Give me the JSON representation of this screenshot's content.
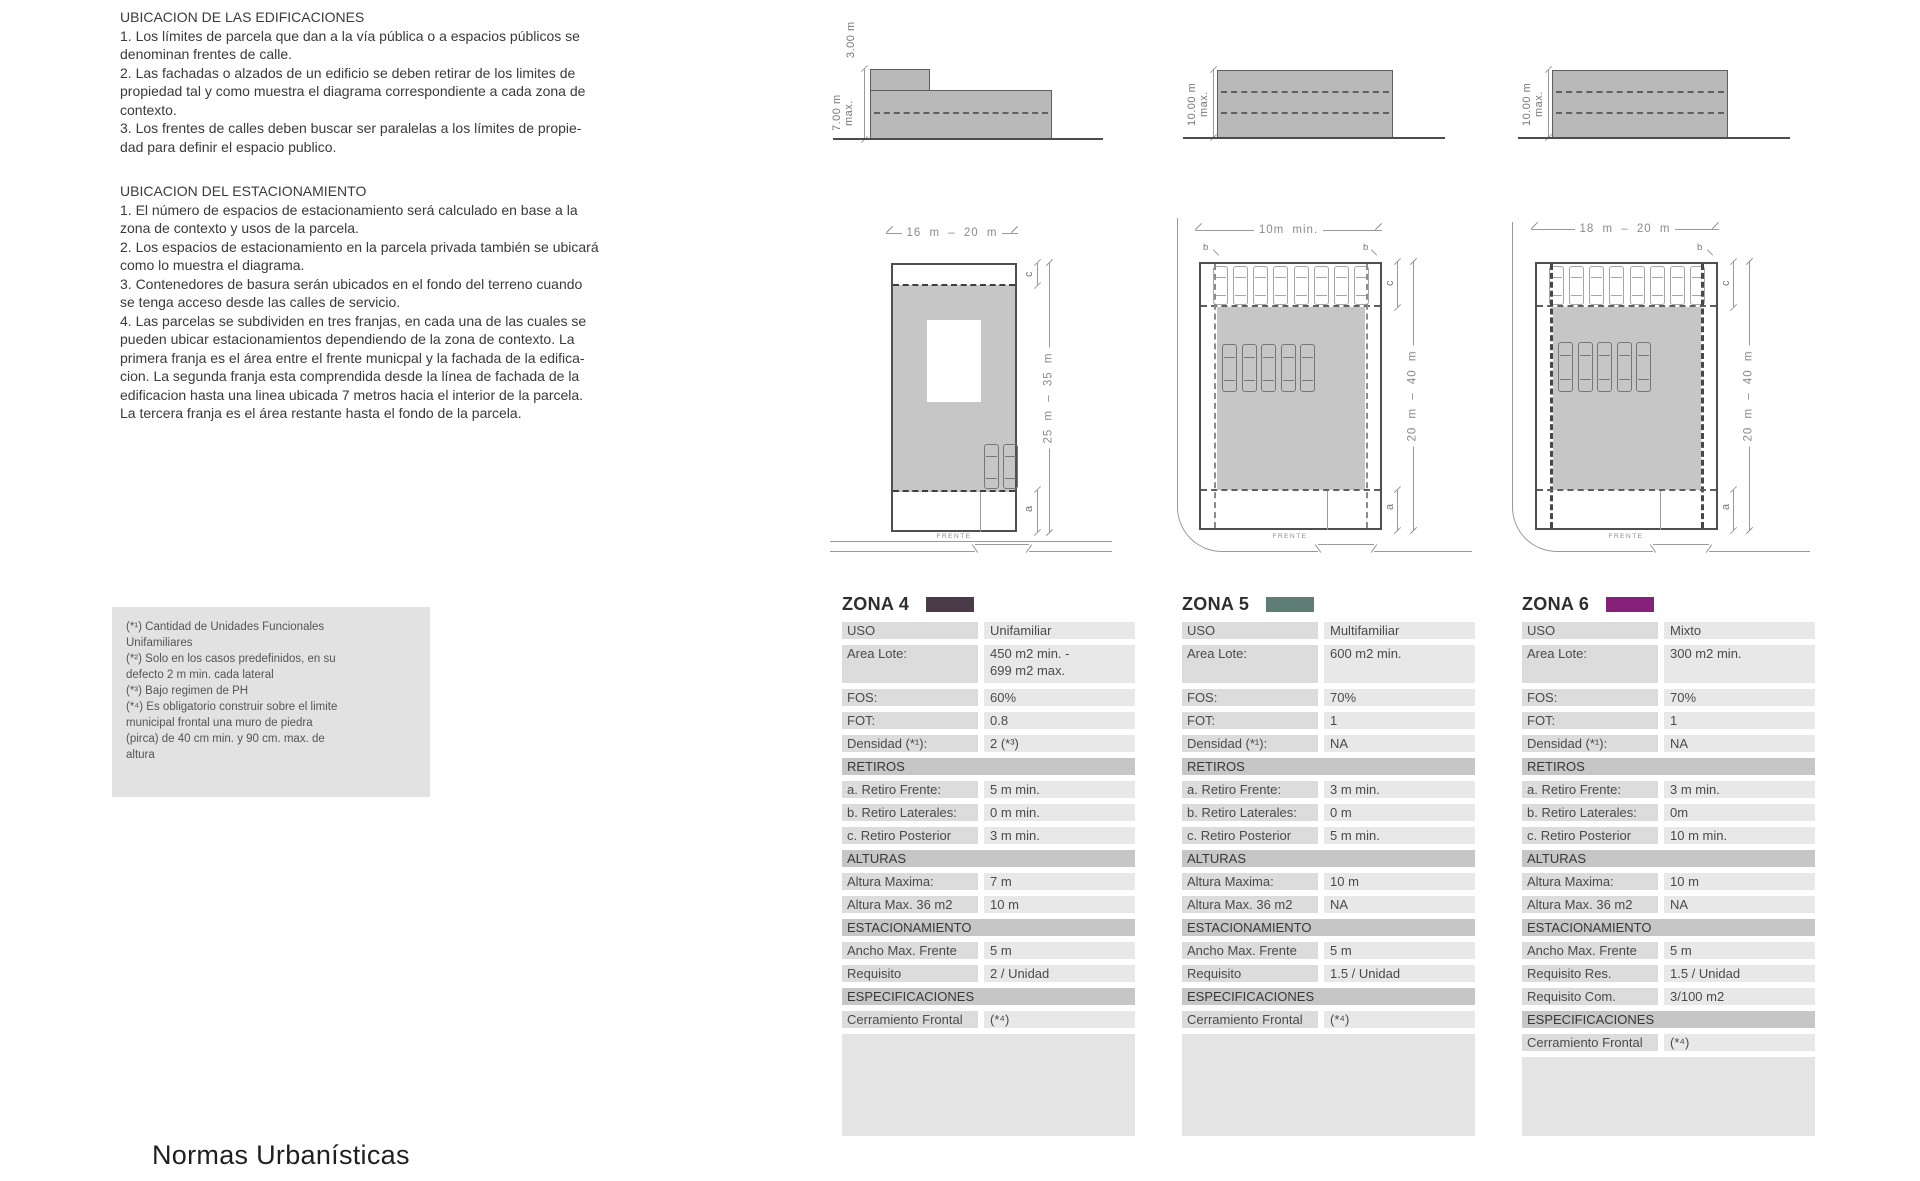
{
  "title": "Normas Urbanísticas",
  "left_column": {
    "section1": {
      "heading": "UBICACION DE LAS EDIFICACIONES",
      "body": "1. Los límites de parcela que dan a la vía pública o a espacios públicos se\ndenominan frentes de calle.\n2. Las fachadas o alzados de un edificio se deben retirar de los limites de\npropiedad tal y como muestra el diagrama correspondiente a cada zona de\ncontexto.\n3. Los frentes de calles deben buscar ser paralelas a los límites de propie-\ndad para definir el espacio publico."
    },
    "section2": {
      "heading": "UBICACION DEL ESTACIONAMIENTO",
      "body": "1. El número de espacios de estacionamiento será calculado en base a la\nzona de contexto y usos de la parcela.\n2. Los espacios de estacionamiento en la parcela privada también se ubicará\ncomo lo muestra el diagrama.\n3. Contenedores de basura serán ubicados en el fondo del terreno cuando\nse tenga acceso desde las calles de servicio.\n4. Las parcelas se subdividen en tres franjas, en cada una de las cuales se\npueden ubicar estacionamientos dependiendo de la zona de contexto. La\nprimera franja es el área entre el frente municpal y la fachada de la edifica-\ncion. La segunda franja esta comprendida desde la línea de fachada de la\nedificacion hasta una linea ubicada 7 metros hacia el interior de la parcela.\nLa tercera franja es el área restante hasta el fondo de la parcela."
    }
  },
  "footnotes": "(*¹) Cantidad de Unidades Funcionales\nUnifamiliares\n(*²) Solo en los casos predefinidos, en su\ndefecto 2 m min. cada lateral\n(*³) Bajo regimen de PH\n(*⁴) Es obligatorio construir sobre el limite\nmunicipal frontal una muro de piedra\n(pirca) de 40 cm min. y 90 cm. max. de\naltura",
  "elevations": [
    {
      "upper_label": "3.00 m",
      "height_label": "7.00 m\nmax."
    },
    {
      "height_label": "10.00 m\nmax."
    },
    {
      "height_label": "10.00 m\nmax."
    }
  ],
  "plans": [
    {
      "width_dim": "16 m – 20 m",
      "depth_dim": "25 m – 35 m",
      "front": "FRENTE",
      "dim_c": "c",
      "dim_a": "a",
      "cars_mid": 2
    },
    {
      "width_dim": "10m min.",
      "depth_dim": "20 m – 40 m",
      "front": "FRENTE",
      "dim_b_left": "b",
      "dim_b_right": "b",
      "dim_c": "c",
      "dim_a": "a",
      "cars_top": 8,
      "cars_mid": 5
    },
    {
      "width_dim": "18 m – 20 m",
      "depth_dim": "20 m – 40 m",
      "front": "FRENTE",
      "dim_b_right": "b",
      "dim_c": "c",
      "dim_a": "a",
      "cars_top": 8,
      "cars_mid": 5
    }
  ],
  "zones": [
    {
      "name": "ZONA 4",
      "swatch": "#4b3a47",
      "rows": [
        {
          "type": "row",
          "label": "USO",
          "value": "Unifamiliar"
        },
        {
          "type": "row",
          "label": "Area Lote:",
          "value": "450 m2 min. -\n699 m2 max.",
          "tall": true
        },
        {
          "type": "row",
          "label": "FOS:",
          "value": "60%"
        },
        {
          "type": "row",
          "label": "FOT:",
          "value": "0.8"
        },
        {
          "type": "row",
          "label": "Densidad (*¹):",
          "value": "2 (*³)"
        },
        {
          "type": "section",
          "label": "RETIROS"
        },
        {
          "type": "row",
          "label": "a. Retiro Frente:",
          "value": "5 m min."
        },
        {
          "type": "row",
          "label": "b. Retiro Laterales:",
          "value": "0 m min."
        },
        {
          "type": "row",
          "label": "c. Retiro Posterior",
          "value": "3 m min."
        },
        {
          "type": "section",
          "label": "ALTURAS"
        },
        {
          "type": "row",
          "label": "Altura Maxima:",
          "value": "7 m"
        },
        {
          "type": "row",
          "label": "Altura Max. 36 m2",
          "value": "10 m"
        },
        {
          "type": "section",
          "label": "ESTACIONAMIENTO"
        },
        {
          "type": "row",
          "label": "Ancho Max. Frente",
          "value": "5 m"
        },
        {
          "type": "row",
          "label": "Requisito",
          "value": "2 / Unidad"
        },
        {
          "type": "section",
          "label": "ESPECIFICACIONES"
        },
        {
          "type": "row",
          "label": "Cerramiento Frontal",
          "value": "(*⁴)"
        }
      ]
    },
    {
      "name": "ZONA 5",
      "swatch": "#5e7d75",
      "rows": [
        {
          "type": "row",
          "label": "USO",
          "value": "Multifamiliar"
        },
        {
          "type": "row",
          "label": "Area Lote:",
          "value": "600 m2 min.",
          "tall": true
        },
        {
          "type": "row",
          "label": "FOS:",
          "value": "70%"
        },
        {
          "type": "row",
          "label": "FOT:",
          "value": "1"
        },
        {
          "type": "row",
          "label": "Densidad (*¹):",
          "value": "NA"
        },
        {
          "type": "section",
          "label": "RETIROS"
        },
        {
          "type": "row",
          "label": "a. Retiro Frente:",
          "value": "3 m min."
        },
        {
          "type": "row",
          "label": "b. Retiro Laterales:",
          "value": "0 m"
        },
        {
          "type": "row",
          "label": "c. Retiro Posterior",
          "value": "5 m min."
        },
        {
          "type": "section",
          "label": "ALTURAS"
        },
        {
          "type": "row",
          "label": "Altura Maxima:",
          "value": "10 m"
        },
        {
          "type": "row",
          "label": "Altura Max. 36 m2",
          "value": "NA"
        },
        {
          "type": "section",
          "label": "ESTACIONAMIENTO"
        },
        {
          "type": "row",
          "label": "Ancho Max. Frente",
          "value": "5 m"
        },
        {
          "type": "row",
          "label": "Requisito",
          "value": "1.5 / Unidad"
        },
        {
          "type": "section",
          "label": "ESPECIFICACIONES"
        },
        {
          "type": "row",
          "label": "Cerramiento Frontal",
          "value": "(*⁴)"
        }
      ]
    },
    {
      "name": "ZONA 6",
      "swatch": "#862179",
      "rows": [
        {
          "type": "row",
          "label": "USO",
          "value": "Mixto"
        },
        {
          "type": "row",
          "label": "Area Lote:",
          "value": "300 m2 min.",
          "tall": true
        },
        {
          "type": "row",
          "label": "FOS:",
          "value": "70%"
        },
        {
          "type": "row",
          "label": "FOT:",
          "value": "1"
        },
        {
          "type": "row",
          "label": "Densidad (*¹):",
          "value": "NA"
        },
        {
          "type": "section",
          "label": "RETIROS"
        },
        {
          "type": "row",
          "label": "a. Retiro Frente:",
          "value": "3 m min."
        },
        {
          "type": "row",
          "label": "b. Retiro Laterales:",
          "value": "0m"
        },
        {
          "type": "row",
          "label": "c. Retiro Posterior",
          "value": "10 m min."
        },
        {
          "type": "section",
          "label": "ALTURAS"
        },
        {
          "type": "row",
          "label": "Altura Maxima:",
          "value": "10 m"
        },
        {
          "type": "row",
          "label": "Altura Max. 36 m2",
          "value": "NA"
        },
        {
          "type": "section",
          "label": "ESTACIONAMIENTO"
        },
        {
          "type": "row",
          "label": "Ancho Max. Frente",
          "value": "5 m"
        },
        {
          "type": "row",
          "label": "Requisito Res.",
          "value": "1.5 / Unidad"
        },
        {
          "type": "row",
          "label": "Requisito Com.",
          "value": "3/100 m2"
        },
        {
          "type": "section",
          "label": "ESPECIFICACIONES"
        },
        {
          "type": "row",
          "label": "Cerramiento Frontal",
          "value": "(*⁴)"
        }
      ]
    }
  ]
}
